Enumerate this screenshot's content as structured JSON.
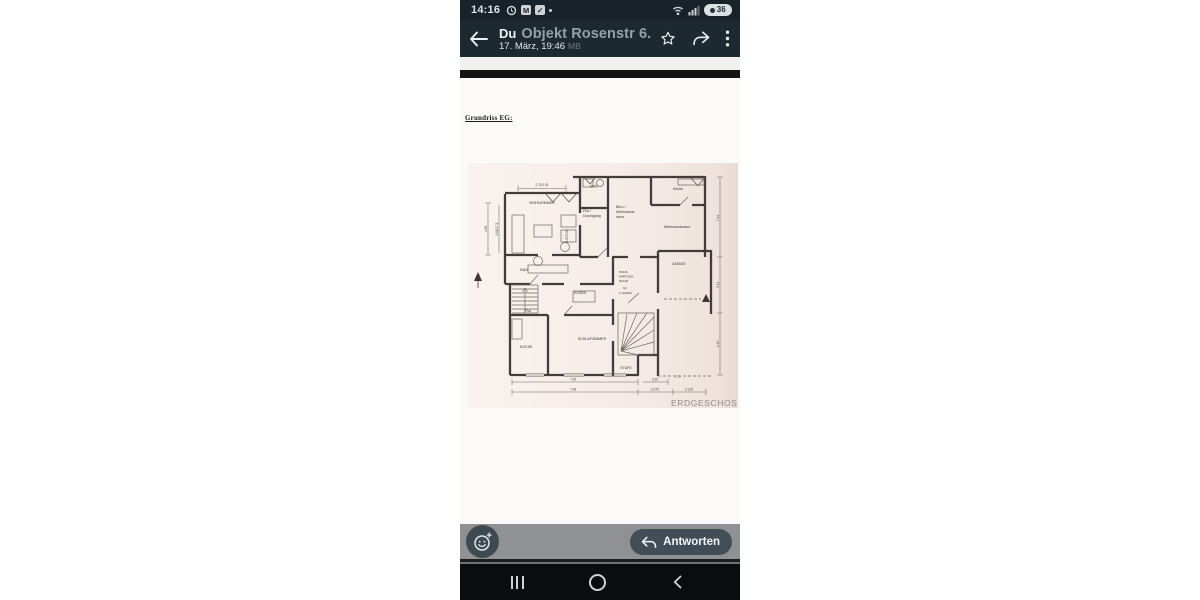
{
  "status_bar": {
    "time": "14:16",
    "battery": "36"
  },
  "app_bar": {
    "sender": "Du",
    "doc_title": "Objekt Rosenstr 6.pdf",
    "timestamp": "17. März, 19:46",
    "meta_ghost": "MB"
  },
  "document": {
    "heading": "Grundriss EG:"
  },
  "floorplan": {
    "sheet_color": "#f6ece7",
    "line_color": "#423d39",
    "title": "ERDGESCHOSS",
    "labels": {
      "wohnzimmer": "WOHNZIMMER",
      "bad_top": "BAD",
      "kueche_top": "Küche",
      "flur1": "Flur /",
      "flur2": "Durchgang",
      "buero1": "Büro /",
      "buero2": "Mehrzweck-",
      "buero3": "raum",
      "mehrzweckraum": "Mehrzweckraum",
      "garage": "GARAGE",
      "essen": "ESSEN",
      "hw1": "HAUS-",
      "hw2": "WIRTSCH.",
      "hw3": "RAUM",
      "hw4": "für",
      "hw5": "1.OG/DG",
      "bad_low": "BAD",
      "flur_low": "Flur",
      "kueche_low": "KÜCHE",
      "schlafzimmer": "SCHLAFZIMMER",
      "stufe": "STUFE"
    },
    "dims": {
      "top": "2.71/2.51",
      "left_outer": "4.38",
      "left_inner": "1.81/1.71",
      "mid": "4.07/3.89",
      "bottom1": "7.99",
      "bottom2": "3.25",
      "bottom3": "17,5",
      "bottom4": "7.98",
      "bottom5": "3.075",
      "bottom6": "3.125",
      "right1": "7.44",
      "right2": "3.41",
      "right3": "2.43"
    }
  },
  "action_bar": {
    "reply_label": "Antworten"
  }
}
